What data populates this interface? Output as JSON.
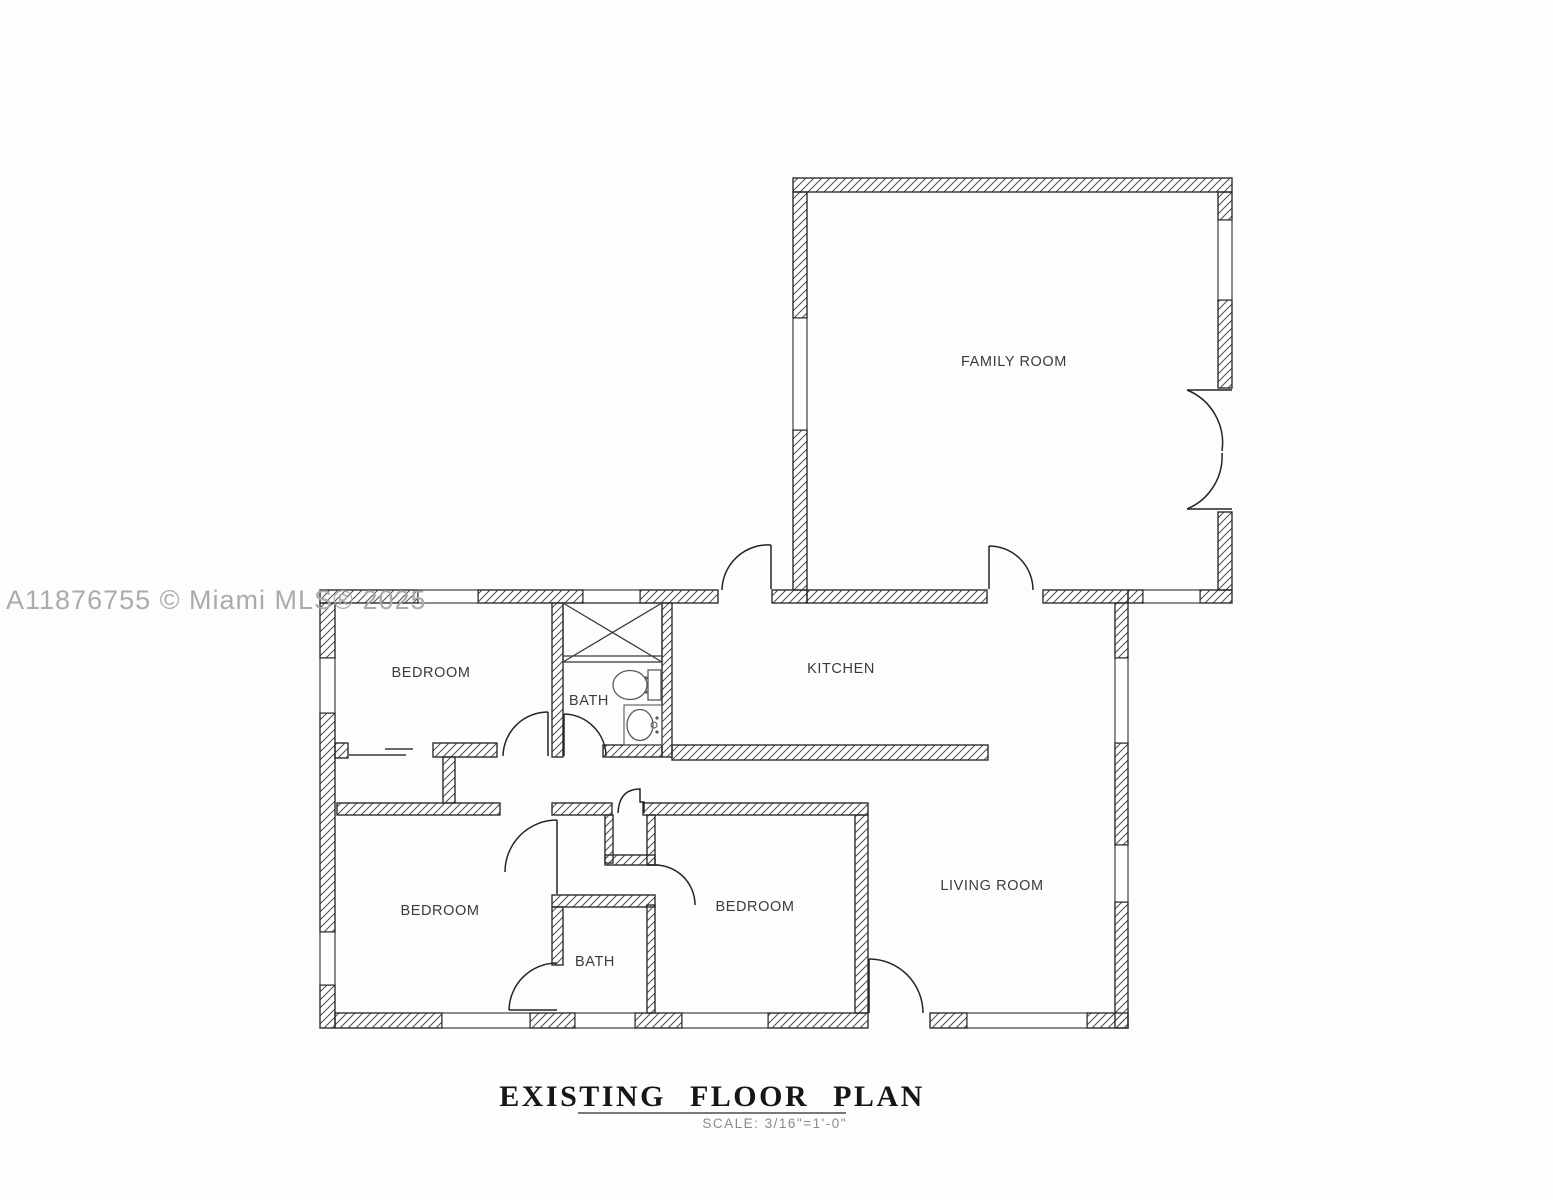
{
  "watermark": "A11876755 © Miami MLS® 2025",
  "title": "EXISTING  FLOOR  PLAN",
  "scale_note": "SCALE:  3/16\"=1'-0\"",
  "rooms": {
    "family_room": "FAMILY ROOM",
    "kitchen": "KITCHEN",
    "living_room": "LIVING ROOM",
    "bedroom_top_left": "BEDROOM",
    "bedroom_bottom_left": "BEDROOM",
    "bedroom_bottom_middle": "BEDROOM",
    "bath_top": "BATH",
    "bath_bottom": "BATH"
  },
  "colors": {
    "wall_outline": "#2f2f2f",
    "hatch_line": "#4d4d4d",
    "label_text": "#3b3b3b",
    "watermark_text": "#ababab",
    "title_text": "#161616",
    "scale_text": "#8a8a8a",
    "background": "#fdfdfc"
  }
}
